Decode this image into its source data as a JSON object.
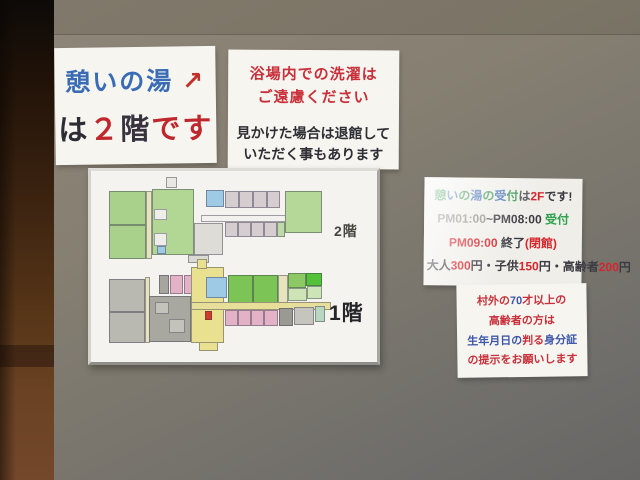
{
  "colors": {
    "wall_upper": "#8e8679",
    "wall_lower": "#686664",
    "pillar_brown": "#553417",
    "paper_white": "#f6f5f0",
    "accent_red": "#c9303a",
    "accent_blue": "#3a6cb6",
    "accent_green": "#2da14c"
  },
  "signs": {
    "floor_notice": {
      "line1_parts": [
        {
          "t": "憩いの湯",
          "c": "#3a6cb6"
        },
        {
          "t": " ↗",
          "c": "#c2302c"
        }
      ],
      "line2_parts": [
        {
          "t": "は",
          "c": "#2c2c35"
        },
        {
          "t": "２",
          "c": "#c0272d"
        },
        {
          "t": "階",
          "c": "#37323e"
        },
        {
          "t": "です",
          "c": "#c0272d"
        }
      ]
    },
    "laundry_notice": {
      "line1_parts": [
        {
          "t": "浴場内での洗濯は",
          "c": "#c9303a"
        }
      ],
      "line2_parts": [
        {
          "t": "ご遠慮ください",
          "c": "#c9303a"
        }
      ],
      "line3_parts": [
        {
          "t": "見かけた場合は退館して",
          "c": "#2e2e35"
        }
      ],
      "line4_parts": [
        {
          "t": "いただく事もあります",
          "c": "#2e2e35"
        }
      ]
    },
    "reception_notice": {
      "line1_parts": [
        {
          "t": "憩",
          "c": "#3f9b55"
        },
        {
          "t": "い",
          "c": "#4a77b8"
        },
        {
          "t": "の",
          "c": "#3f9b55"
        },
        {
          "t": "湯",
          "c": "#4a77b8"
        },
        {
          "t": "の",
          "c": "#3f9b55"
        },
        {
          "t": "受",
          "c": "#4a77b8"
        },
        {
          "t": "付",
          "c": "#3f9b55"
        },
        {
          "t": "は",
          "c": "#55555c"
        },
        {
          "t": "2F",
          "c": "#d6252b"
        },
        {
          "t": "です!",
          "c": "#3a3a40"
        }
      ],
      "line2_parts": [
        {
          "t": "PM01:00",
          "c": "#8f8b85"
        },
        {
          "t": "~",
          "c": "#4a4a50"
        },
        {
          "t": "PM08:00 ",
          "c": "#3b3b42"
        },
        {
          "t": "受付",
          "c": "#2da14c"
        }
      ],
      "line3_parts": [
        {
          "t": "PM09:00 ",
          "c": "#d6252b"
        },
        {
          "t": "終了",
          "c": "#3b3b42"
        },
        {
          "t": "(閉館)",
          "c": "#d6252b"
        }
      ],
      "line4_parts": [
        {
          "t": "大人",
          "c": "#3b3b42"
        },
        {
          "t": "300",
          "c": "#d6252b"
        },
        {
          "t": "円・",
          "c": "#3b3b42"
        },
        {
          "t": "子供",
          "c": "#3b3b42"
        },
        {
          "t": "150",
          "c": "#d6252b"
        },
        {
          "t": "円・",
          "c": "#3b3b42"
        },
        {
          "t": "高齢者",
          "c": "#3b3b42"
        },
        {
          "t": "200",
          "c": "#d6252b"
        },
        {
          "t": "円",
          "c": "#3b3b42"
        }
      ]
    },
    "id_notice": {
      "line1_parts": [
        {
          "t": "村外の",
          "c": "#c9303a"
        },
        {
          "t": "70",
          "c": "#3b55a8"
        },
        {
          "t": "才以上の",
          "c": "#c9303a"
        }
      ],
      "line2_parts": [
        {
          "t": "高齢者の方は",
          "c": "#c9303a"
        }
      ],
      "line3_parts": [
        {
          "t": "生年月日の",
          "c": "#3b55a8"
        },
        {
          "t": "判る",
          "c": "#c9303a"
        },
        {
          "t": "身分証",
          "c": "#3b55a8"
        }
      ],
      "line4_parts": [
        {
          "t": "の提示をお願いします",
          "c": "#c9303a"
        }
      ]
    }
  },
  "floorplan": {
    "label_2f": "2階",
    "label_1f": "1階",
    "rooms_2f": [
      {
        "x": 18,
        "y": 20,
        "w": 37,
        "h": 34,
        "c": "#a9d18c"
      },
      {
        "x": 18,
        "y": 54,
        "w": 37,
        "h": 34,
        "c": "#a9d18c"
      },
      {
        "x": 55,
        "y": 20,
        "w": 6,
        "h": 68,
        "c": "#e7e3bd"
      },
      {
        "x": 61,
        "y": 18,
        "w": 42,
        "h": 66,
        "c": "#b2d795"
      },
      {
        "x": 63,
        "y": 38,
        "w": 13,
        "h": 11,
        "c": "#eeedea"
      },
      {
        "x": 63,
        "y": 62,
        "w": 13,
        "h": 13,
        "c": "#eeedea"
      },
      {
        "x": 66,
        "y": 75,
        "w": 9,
        "h": 8,
        "c": "#9fcbe4"
      },
      {
        "x": 75,
        "y": 6,
        "w": 11,
        "h": 11,
        "c": "#e9e7e1"
      },
      {
        "x": 103,
        "y": 52,
        "w": 29,
        "h": 32,
        "c": "#dddcd6"
      },
      {
        "x": 110,
        "y": 44,
        "w": 121,
        "h": 7,
        "c": "#f2f1ed"
      },
      {
        "x": 115,
        "y": 19,
        "w": 18,
        "h": 17,
        "c": "#9ecae6"
      },
      {
        "x": 134,
        "y": 20,
        "w": 14,
        "h": 17,
        "c": "#d6cdd1"
      },
      {
        "x": 148,
        "y": 20,
        "w": 14,
        "h": 17,
        "c": "#d6cdd1"
      },
      {
        "x": 162,
        "y": 20,
        "w": 14,
        "h": 17,
        "c": "#d6cdd1"
      },
      {
        "x": 176,
        "y": 20,
        "w": 13,
        "h": 17,
        "c": "#d6cdd1"
      },
      {
        "x": 134,
        "y": 51,
        "w": 13,
        "h": 15,
        "c": "#d6cdd1"
      },
      {
        "x": 147,
        "y": 51,
        "w": 13,
        "h": 15,
        "c": "#d6cdd1"
      },
      {
        "x": 160,
        "y": 51,
        "w": 13,
        "h": 15,
        "c": "#d6cdd1"
      },
      {
        "x": 173,
        "y": 51,
        "w": 13,
        "h": 15,
        "c": "#d6cdd1"
      },
      {
        "x": 186,
        "y": 51,
        "w": 8,
        "h": 15,
        "c": "#bfd9a8"
      },
      {
        "x": 194,
        "y": 20,
        "w": 37,
        "h": 42,
        "c": "#b5d899"
      },
      {
        "x": 97,
        "y": 84,
        "w": 21,
        "h": 8,
        "c": "#dad9d3"
      }
    ],
    "rooms_1f": [
      {
        "x": 18,
        "y": 108,
        "w": 36,
        "h": 33,
        "c": "#bab9b1"
      },
      {
        "x": 18,
        "y": 141,
        "w": 36,
        "h": 31,
        "c": "#bab9b1"
      },
      {
        "x": 54,
        "y": 106,
        "w": 5,
        "h": 66,
        "c": "#e7e3bd"
      },
      {
        "x": 68,
        "y": 104,
        "w": 10,
        "h": 19,
        "c": "#a6a69f"
      },
      {
        "x": 79,
        "y": 104,
        "w": 13,
        "h": 19,
        "c": "#e3b2c7"
      },
      {
        "x": 93,
        "y": 104,
        "w": 12,
        "h": 19,
        "c": "#e3b2c7"
      },
      {
        "x": 58,
        "y": 125,
        "w": 42,
        "h": 46,
        "c": "#a8a8a1"
      },
      {
        "x": 64,
        "y": 131,
        "w": 14,
        "h": 12,
        "c": "#c3c3bc"
      },
      {
        "x": 78,
        "y": 148,
        "w": 16,
        "h": 14,
        "c": "#c3c3bc"
      },
      {
        "x": 100,
        "y": 96,
        "w": 33,
        "h": 76,
        "c": "#e9e190"
      },
      {
        "x": 106,
        "y": 88,
        "w": 10,
        "h": 10,
        "c": "#e9e190"
      },
      {
        "x": 115,
        "y": 106,
        "w": 21,
        "h": 21,
        "c": "#9ecae6"
      },
      {
        "x": 137,
        "y": 104,
        "w": 25,
        "h": 28,
        "c": "#7cc455"
      },
      {
        "x": 162,
        "y": 104,
        "w": 25,
        "h": 28,
        "c": "#7cc455"
      },
      {
        "x": 187,
        "y": 104,
        "w": 10,
        "h": 28,
        "c": "#e7e3bd"
      },
      {
        "x": 197,
        "y": 102,
        "w": 18,
        "h": 15,
        "c": "#8cc863"
      },
      {
        "x": 215,
        "y": 102,
        "w": 16,
        "h": 13,
        "c": "#54c238"
      },
      {
        "x": 197,
        "y": 117,
        "w": 19,
        "h": 13,
        "c": "#cde5b6"
      },
      {
        "x": 216,
        "y": 115,
        "w": 15,
        "h": 13,
        "c": "#cde5b6"
      },
      {
        "x": 100,
        "y": 131,
        "w": 140,
        "h": 8,
        "c": "#e7df99"
      },
      {
        "x": 134,
        "y": 139,
        "w": 13,
        "h": 16,
        "c": "#e3b2c7"
      },
      {
        "x": 147,
        "y": 139,
        "w": 13,
        "h": 16,
        "c": "#e3b2c7"
      },
      {
        "x": 160,
        "y": 139,
        "w": 13,
        "h": 16,
        "c": "#e3b2c7"
      },
      {
        "x": 173,
        "y": 139,
        "w": 14,
        "h": 16,
        "c": "#e3b2c7"
      },
      {
        "x": 188,
        "y": 137,
        "w": 14,
        "h": 18,
        "c": "#9a9a93"
      },
      {
        "x": 203,
        "y": 136,
        "w": 20,
        "h": 18,
        "c": "#c5c5be"
      },
      {
        "x": 224,
        "y": 135,
        "w": 10,
        "h": 16,
        "c": "#b8d7c1"
      },
      {
        "x": 114,
        "y": 140,
        "w": 7,
        "h": 9,
        "c": "#d03a28"
      },
      {
        "x": 108,
        "y": 171,
        "w": 19,
        "h": 9,
        "c": "#e9e190"
      }
    ]
  }
}
